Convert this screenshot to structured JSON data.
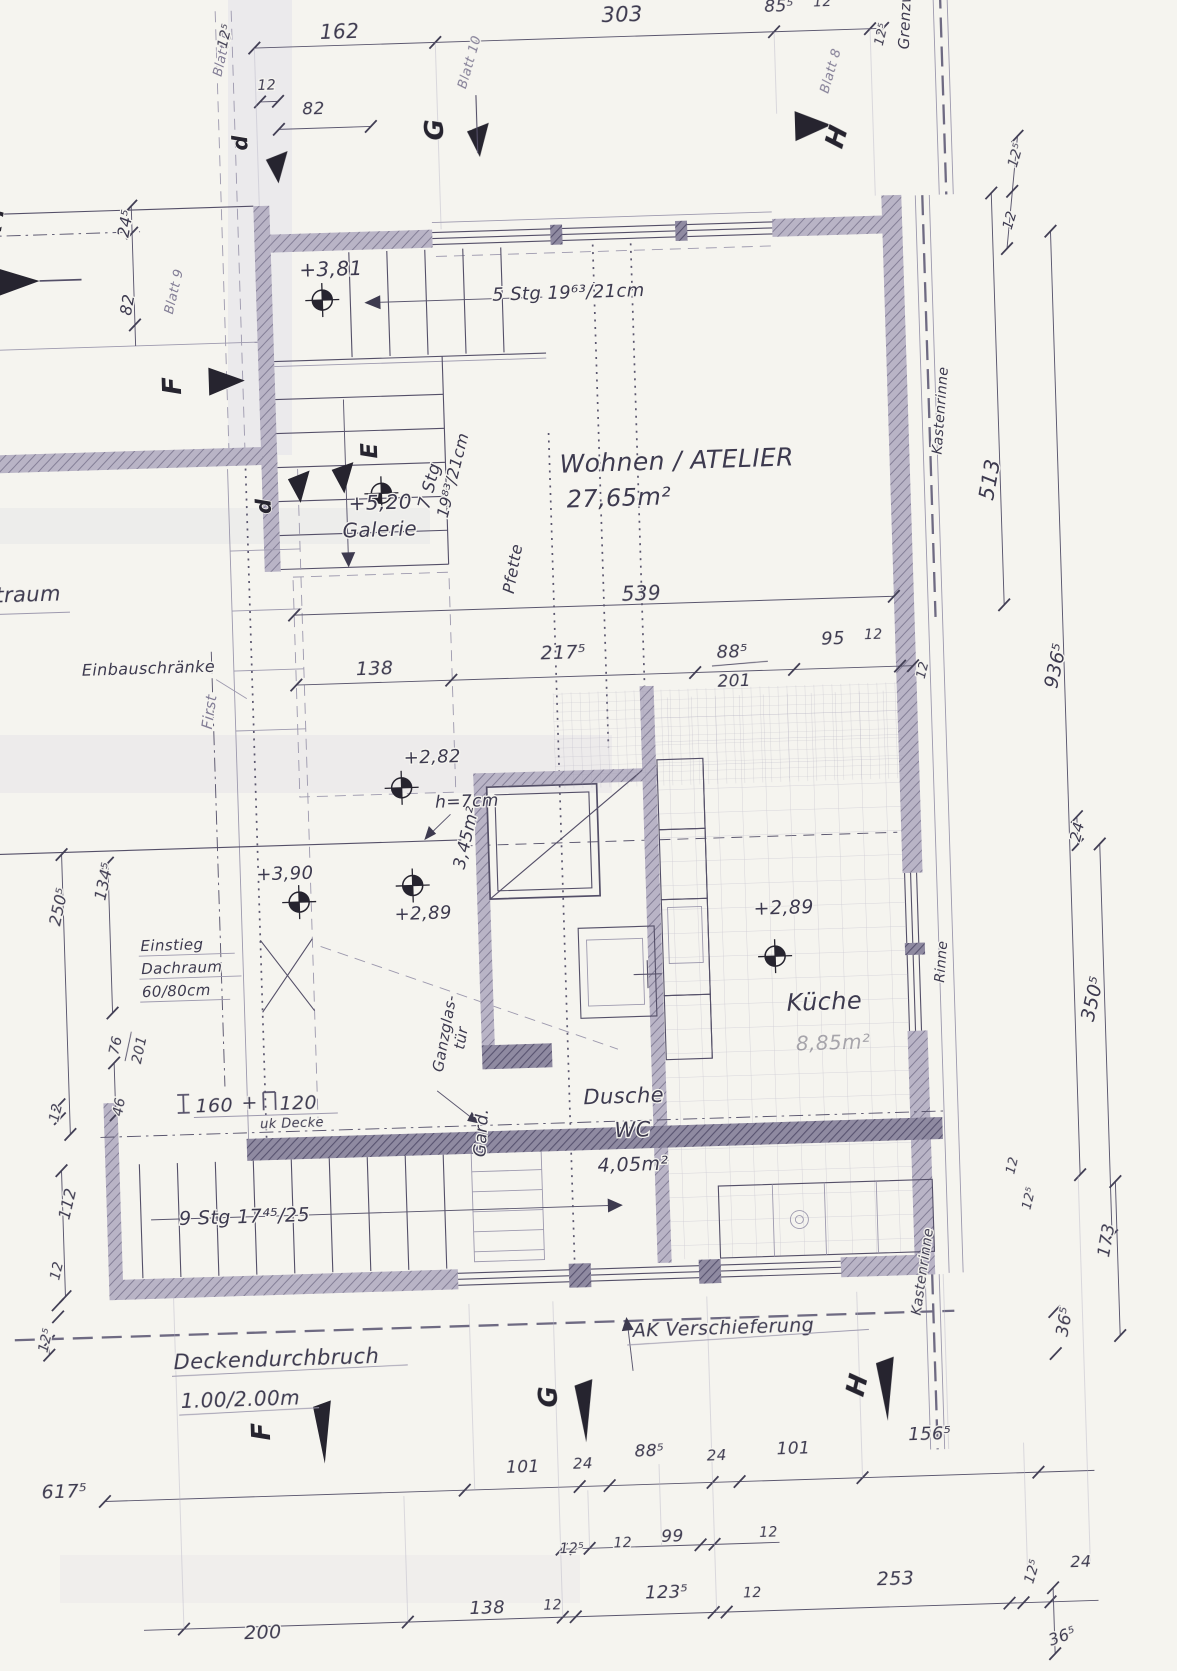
{
  "colors": {
    "paper": "#f5f4ef",
    "ink": "#3d3a4f",
    "pencil": "#9d99ae",
    "wall_hatch": "#b9b4c6",
    "wall_dark": "#8f8aa1",
    "marker": "#26242f"
  },
  "rooms": {
    "wohnen_name": "Wohnen / ATELIER",
    "wohnen_area": "27,65m²",
    "kueche_name": "Küche",
    "kueche_area": "8,85m²",
    "dusche_1": "Dusche",
    "dusche_2": "WC",
    "dusche_area": "4,05m²",
    "galerie_level": "+5,20",
    "galerie_name": "Galerie",
    "bad_flaeche": "3,45m²"
  },
  "levels": {
    "l381": "+3,81",
    "l282": "+2,82",
    "l390": "+3,90",
    "l289_bad": "+2,89",
    "l289_kueche": "+2,89"
  },
  "stairs": {
    "top": "5 Stg 19⁶³/21cm",
    "mid_a": "7 Stg",
    "mid_b": "19⁸³/21cm",
    "bottom": "9 Stg 17⁴⁵/25"
  },
  "beam": {
    "v1": "160",
    "plus": "+",
    "v2": "120",
    "sub": "uk Decke"
  },
  "annotations": {
    "einbau": "Einbauschränke",
    "einstieg_1": "Einstieg",
    "einstieg_2": "Dachraum",
    "einstieg_3": "60/80cm",
    "hoehe": "h=7cm",
    "ganzglas_1": "Ganzglas-",
    "ganzglas_2": "tür",
    "gard": "Gard.",
    "first": "First",
    "pfette": "Pfette",
    "grenzwand": "Grenzwand",
    "kastenrinne_top": "Kastenrinne",
    "kastenrinne_bottom": "Kastenrinne",
    "rinne": "Rinne",
    "traum": "traum",
    "decke_1": "Deckendurchbruch",
    "decke_2": "1.00/2.00m",
    "ak": "AK Verschieferung"
  },
  "sections": {
    "c": "C",
    "d_top": "d",
    "d_mid": "d",
    "e": "E",
    "f_left": "F",
    "f_bottom": "F",
    "g_top": "G",
    "g_bottom": "G",
    "h_top": "H",
    "h_bottom": "H"
  },
  "blatt": {
    "b5": "Blatt 5",
    "b9": "Blatt 9",
    "b10": "Blatt 10",
    "b8": "Blatt 8"
  },
  "dims": {
    "top": {
      "a12_5": "12⁵",
      "a162": "162",
      "a12": "12",
      "a82": "82",
      "a303": "303",
      "a85_5": "85⁵",
      "b12": "12",
      "b12_5": "12⁵"
    },
    "left": {
      "a24_5": "24⁵",
      "a82": "82",
      "a250_5": "250⁵",
      "a134_5": "134⁵",
      "a76": "76",
      "a201": "201",
      "a46": "46",
      "a12": "12",
      "a112": "112",
      "b12": "12",
      "b12_5": "12⁵"
    },
    "mid": {
      "a138": "138",
      "a217_5": "217⁵",
      "a88_5": "88⁵",
      "a201": "201",
      "a95": "95",
      "a12": "12",
      "a539": "539"
    },
    "right": {
      "r12_5": "12⁵",
      "r12": "12",
      "a513": "513",
      "a936_5": "936⁵",
      "a24": "24",
      "a350_5": "350⁵",
      "a12wall": "12",
      "b12": "12",
      "b12_5": "12⁵",
      "a173": "173",
      "a36_5": "36⁵"
    },
    "bottom_a": {
      "a617_5": "617⁵",
      "a101": "101",
      "a24": "24",
      "a88_5": "88⁵",
      "b24": "24",
      "b101": "101",
      "a156_5": "156⁵"
    },
    "bottom_b": {
      "a12_5": "12⁵",
      "a12": "12",
      "a99": "99",
      "b12": "12"
    },
    "bottom_c": {
      "a200": "200",
      "a138": "138",
      "a12": "12",
      "a123_5": "123⁵",
      "b12": "12",
      "a253": "253",
      "b12_5": "12⁵",
      "a24": "24",
      "a36_5": "36⁵"
    }
  }
}
